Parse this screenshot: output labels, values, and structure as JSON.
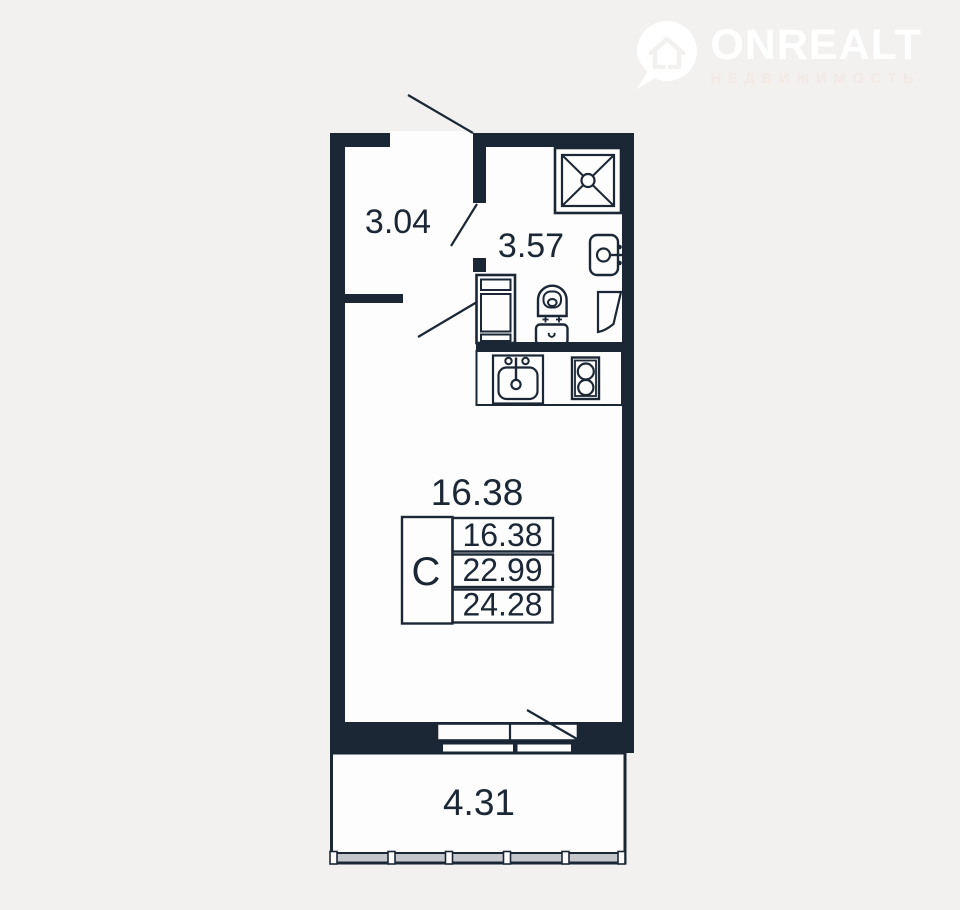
{
  "logo": {
    "brand": "ONREALT",
    "subtitle": "НЕДВИЖИМОСТЬ"
  },
  "plan": {
    "hallway_area": "3.04",
    "bathroom_area": "3.57",
    "room_area_large": "16.38",
    "balcony_area": "4.31",
    "table": {
      "type": "С",
      "rows": [
        "16.38",
        "22.99",
        "24.28"
      ]
    },
    "colors": {
      "wall": "#1b2735",
      "background": "#f2f1ef",
      "interior": "#fdfdfd",
      "glazing_fill": "#c3c7cc"
    }
  }
}
